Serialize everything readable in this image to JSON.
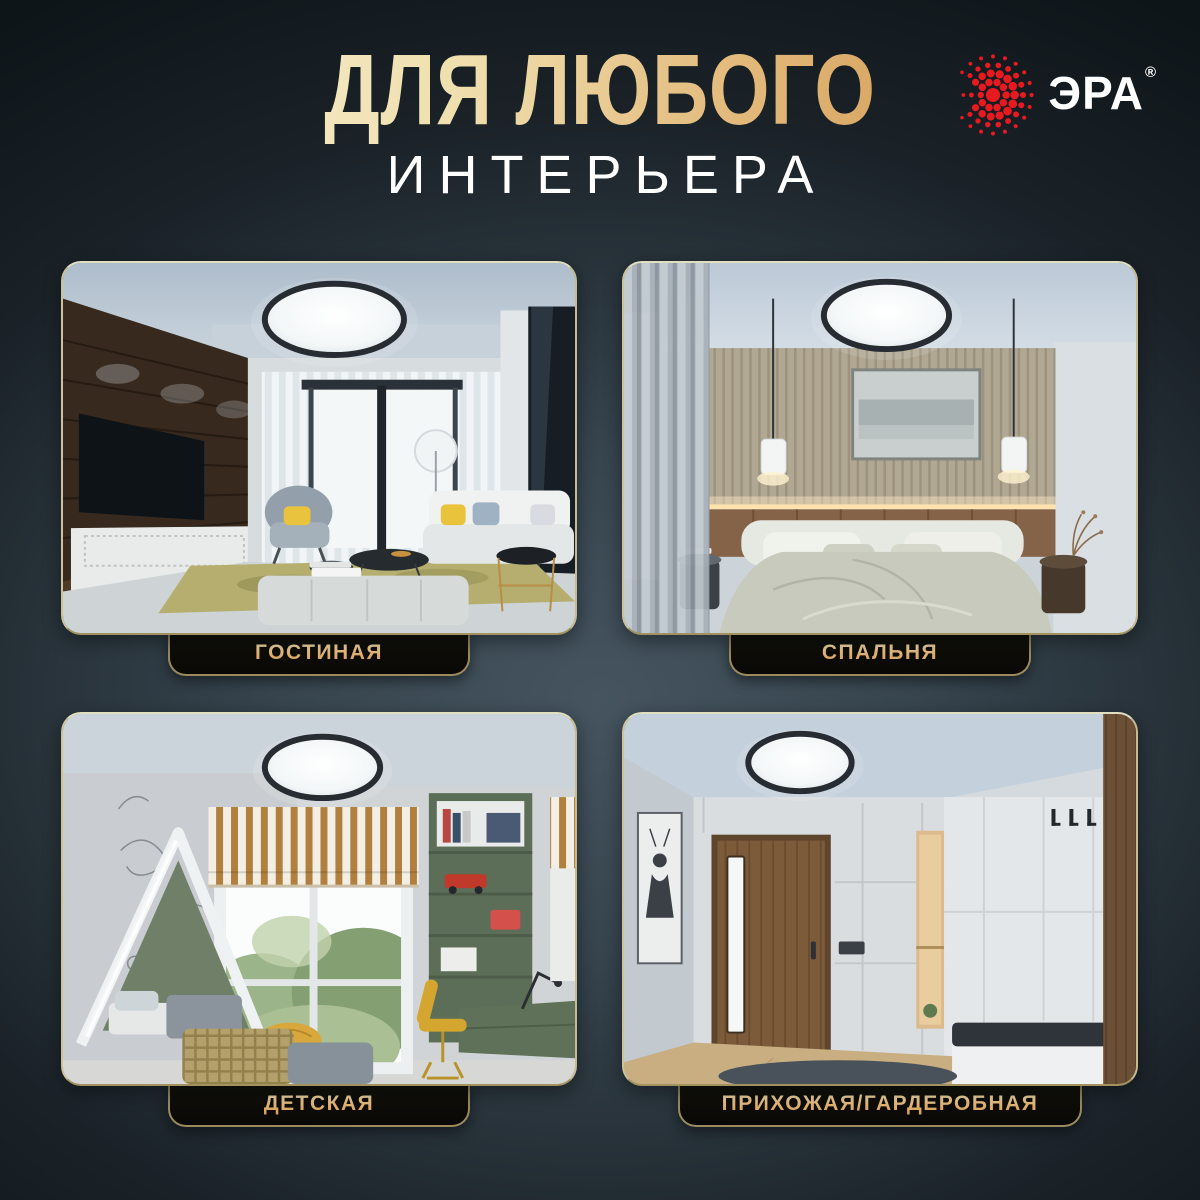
{
  "header": {
    "title": "ДЛЯ ЛЮБОГО",
    "subtitle": "ИНТЕРЬЕРА"
  },
  "logo": {
    "brand": "ЭРА",
    "registered": "®",
    "icon": "era-sunburst-icon",
    "brand_red": "#e8191f",
    "text_color": "#ffffff"
  },
  "rooms": [
    {
      "id": "living-room",
      "label": "ГОСТИНАЯ"
    },
    {
      "id": "bedroom",
      "label": "СПАЛЬНЯ"
    },
    {
      "id": "kids-room",
      "label": "ДЕТСКАЯ"
    },
    {
      "id": "hallway",
      "label": "ПРИХОЖАЯ/ГАРДЕРОБНАЯ"
    }
  ],
  "colors": {
    "title_gradient_start": "#f7eecd",
    "title_gradient_end": "#d0954e",
    "label_gold": "#e7bd7c",
    "card_border": "#c6ba8e",
    "background_center": "#45545f",
    "background_edge": "#0e1519"
  }
}
